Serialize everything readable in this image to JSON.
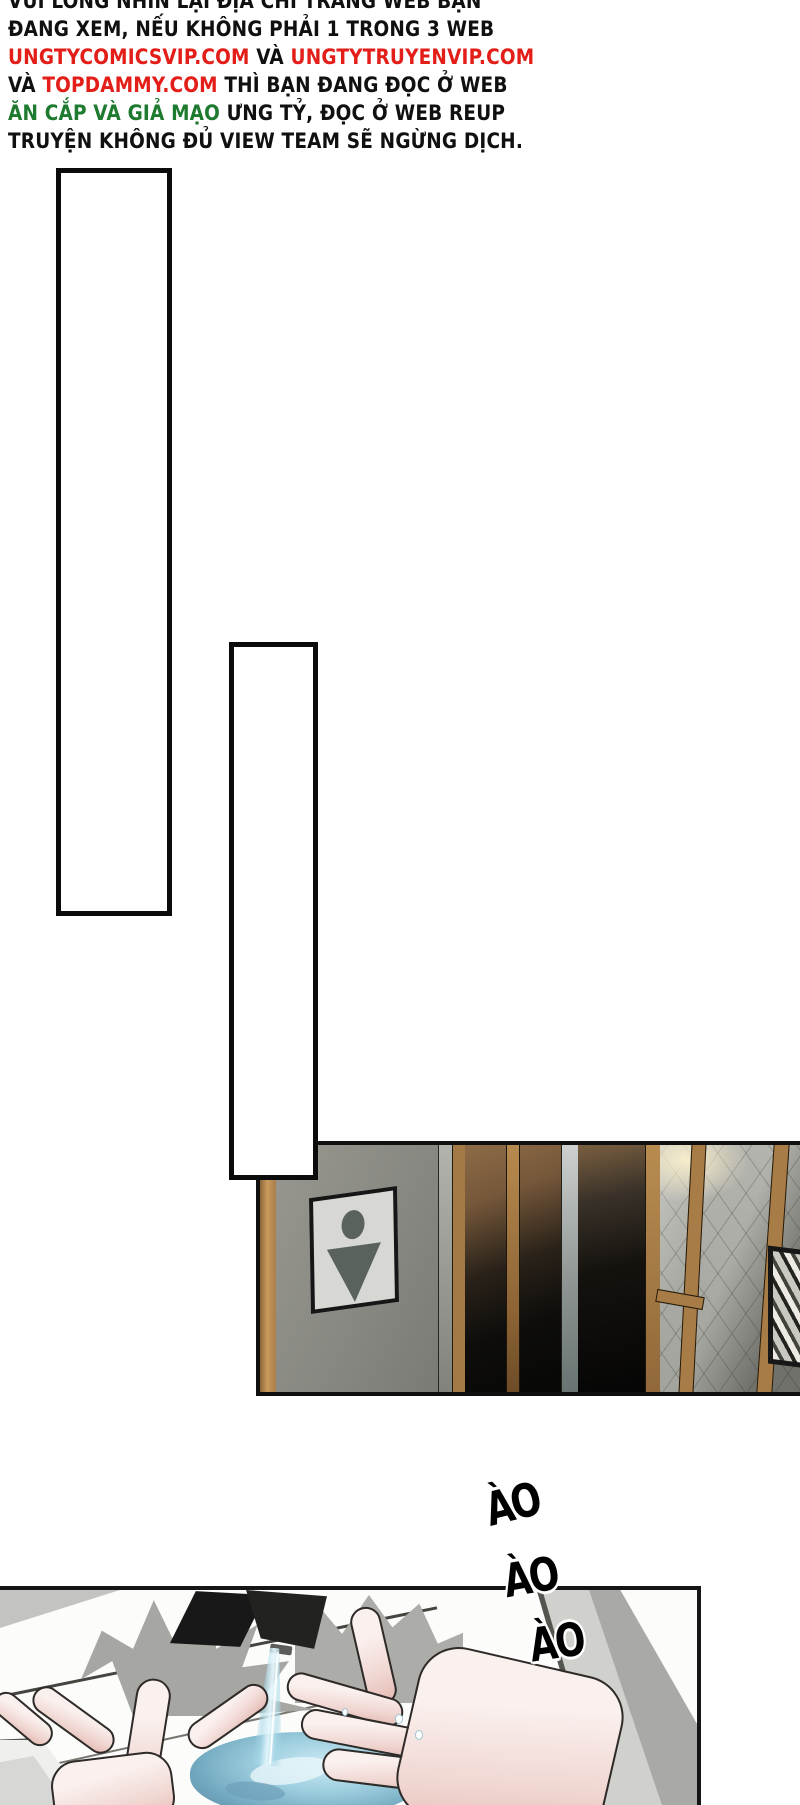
{
  "page": {
    "background": "#ffffff",
    "type": "webtoon-comic-page"
  },
  "colors": {
    "link_red": "#e31e18",
    "warning_green": "#1d7a2f",
    "ink_black": "#101010",
    "wood_tan": "#b98b55",
    "corridor_wall_gray": "#8f8f89",
    "gold_frame": "#a87c46",
    "water_blue": "#9ecfdf",
    "skin_tone": "#f7ece9",
    "shadow_gray": "#a6a6a2"
  },
  "warning": {
    "lines": [
      {
        "segments": [
          {
            "text": "VUI LÒNG NHÌN LẠI ĐỊA CHỈ TRANG WEB BẠN"
          }
        ]
      },
      {
        "segments": [
          {
            "text": "ĐANG XEM, NẾU KHÔNG PHẢI 1 TRONG 3 WEB"
          }
        ]
      },
      {
        "segments": [
          {
            "text": "UNGTYCOMICSVIP.COM",
            "style": "red"
          },
          {
            "text": " VÀ "
          },
          {
            "text": "UNGTYTRUYENVIP.COM",
            "style": "red"
          }
        ]
      },
      {
        "segments": [
          {
            "text": "VÀ "
          },
          {
            "text": "TOPDAMMY.COM",
            "style": "red"
          },
          {
            "text": " THÌ BẠN ĐANG ĐỌC Ở WEB"
          }
        ]
      },
      {
        "segments": [
          {
            "text": "ĂN CẮP VÀ GIẢ MẠO",
            "style": "green"
          },
          {
            "text": " ƯNG TỶ, ĐỌC Ở WEB REUP"
          }
        ]
      },
      {
        "segments": [
          {
            "text": "TRUYỆN KHÔNG ĐỦ VIEW TEAM SẼ NGỪNG DỊCH."
          }
        ]
      }
    ]
  },
  "speech_boxes": [
    {
      "id": 1,
      "content": ""
    },
    {
      "id": 2,
      "content": ""
    }
  ],
  "photo_panel": {
    "description": "corridor with restroom sign, wood trim, dark glass doors, gold frames, tiled wall, picture frame",
    "restroom_sign_icon": "restroom-person-icon"
  },
  "sfx": {
    "items": [
      {
        "text": "ÀO"
      },
      {
        "text": "ÀO"
      },
      {
        "text": "ÀO"
      }
    ]
  },
  "sink_panel": {
    "description": "hands washing under faucet with blue water stream and pool"
  }
}
